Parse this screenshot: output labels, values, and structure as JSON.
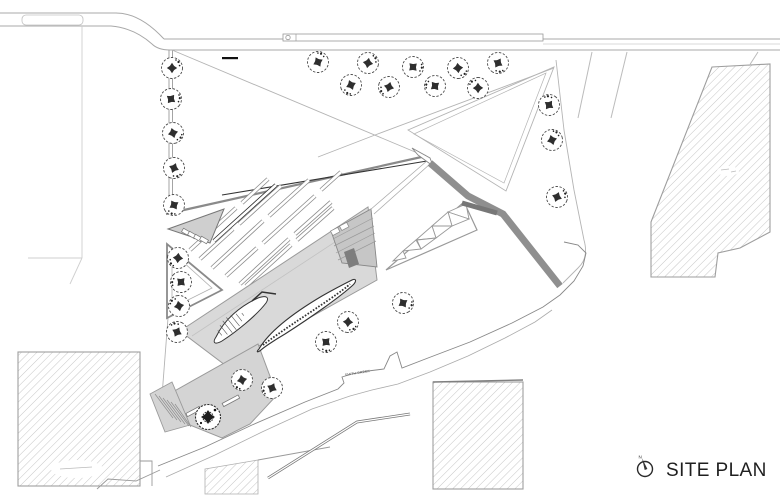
{
  "annotation": {
    "title": "SITE PLAN",
    "north_label": "N",
    "north_icon": "north-arrow-icon",
    "title_color": "#1f1f1f"
  },
  "labels": {
    "creek": "SMITH CREEK"
  },
  "plan": {
    "colors": {
      "paper": "#ffffff",
      "thin_line": "#b4b4b4",
      "medium_line": "#8f8f8f",
      "dark_line": "#333333",
      "building_fill": "#d9d9d9",
      "plaza_fill": "#d4d4d4",
      "bridge_fill": "#8f8f8f",
      "hatch_line": "#c6c6c6"
    },
    "trees": [
      [
        172,
        68
      ],
      [
        171,
        99
      ],
      [
        173,
        133
      ],
      [
        174,
        168
      ],
      [
        174,
        205
      ],
      [
        178,
        258
      ],
      [
        181,
        282
      ],
      [
        179,
        306
      ],
      [
        177,
        332
      ],
      [
        318,
        62
      ],
      [
        368,
        63
      ],
      [
        413,
        67
      ],
      [
        458,
        68
      ],
      [
        498,
        63
      ],
      [
        351,
        85
      ],
      [
        389,
        87
      ],
      [
        435,
        86
      ],
      [
        478,
        88
      ],
      [
        549,
        105
      ],
      [
        552,
        140
      ],
      [
        557,
        197
      ],
      [
        403,
        303
      ],
      [
        348,
        322
      ],
      [
        326,
        342
      ],
      [
        242,
        380
      ],
      [
        272,
        388
      ]
    ],
    "dense_trees": [
      [
        208,
        417
      ]
    ],
    "parking_bars": [
      [
        214,
        241,
        276,
        185,
        "dark"
      ],
      [
        190,
        250,
        236,
        208
      ],
      [
        242,
        203,
        268,
        179
      ],
      [
        200,
        259,
        233,
        229
      ],
      [
        239,
        224,
        281,
        186
      ],
      [
        212,
        268,
        263,
        221
      ],
      [
        269,
        216,
        309,
        180
      ],
      [
        226,
        276,
        257,
        248
      ],
      [
        263,
        243,
        315,
        196
      ],
      [
        321,
        190,
        341,
        172
      ],
      [
        240,
        284,
        289,
        239
      ],
      [
        295,
        234,
        331,
        202
      ],
      [
        246,
        286,
        291,
        245
      ],
      [
        297,
        240,
        333,
        208
      ]
    ],
    "leaf1_axis": [
      216,
      336,
      262,
      299
    ],
    "scale_bar": [
      222,
      57,
      16,
      2.2
    ]
  }
}
